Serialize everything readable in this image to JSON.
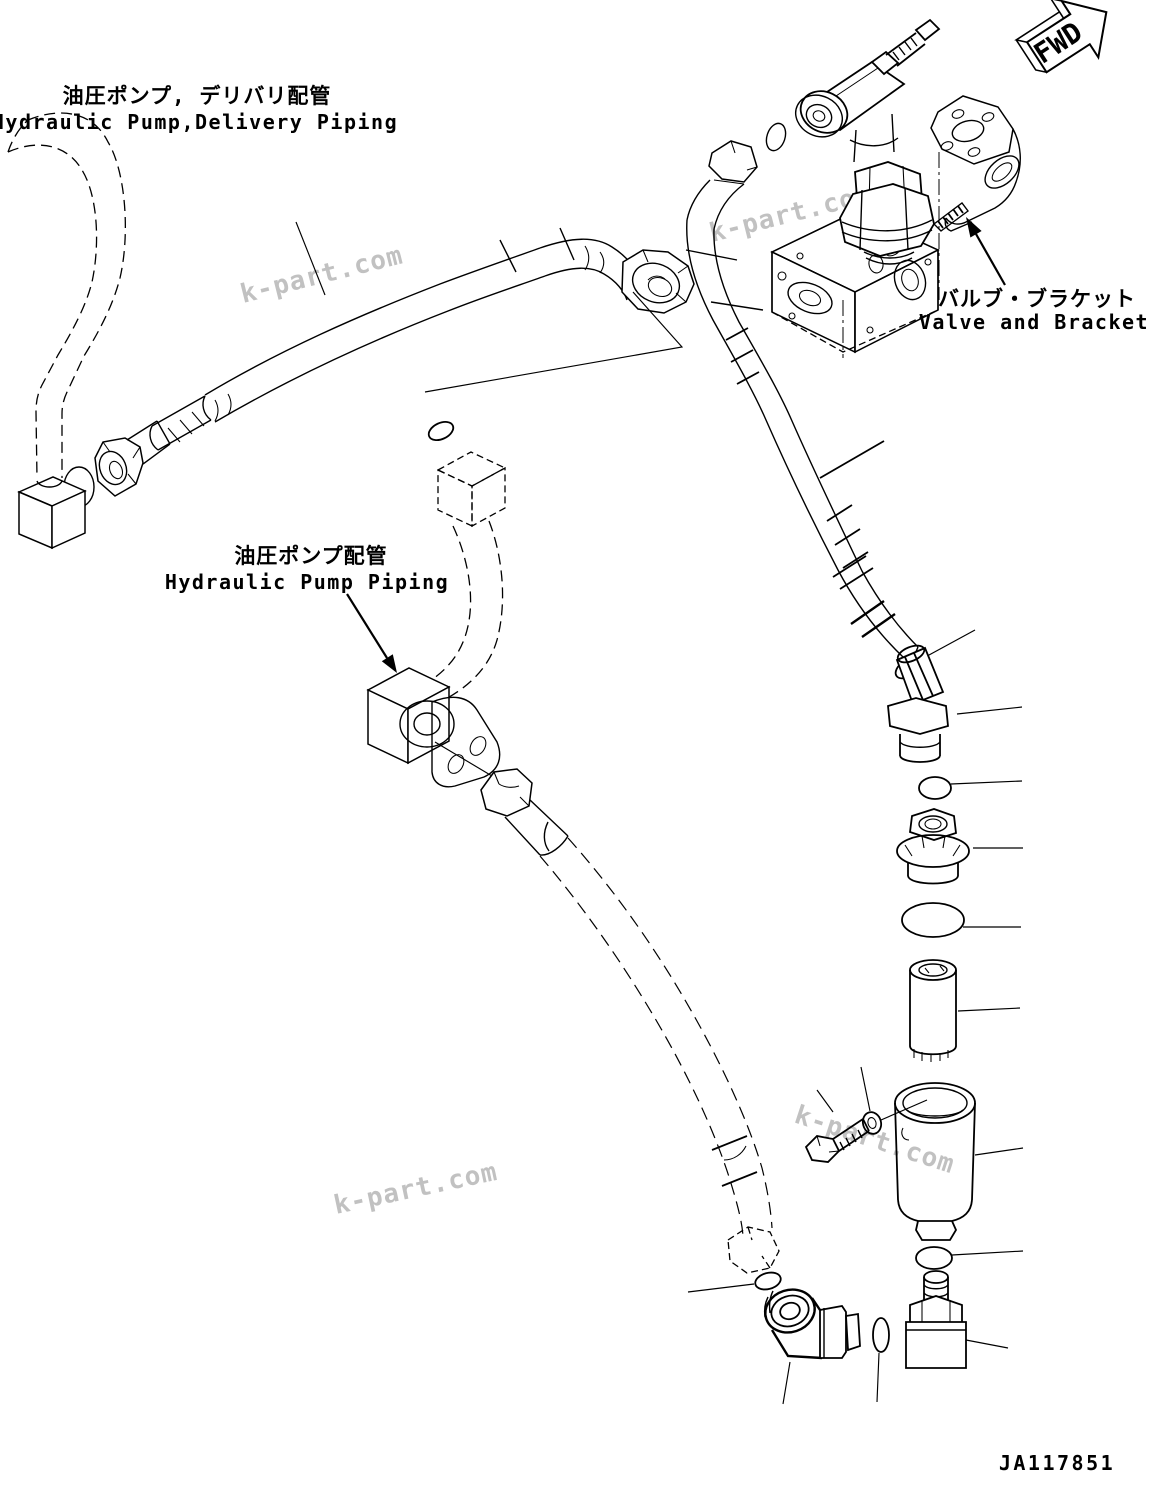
{
  "page": {
    "background": "#ffffff",
    "line_color": "#000000",
    "watermark_color": "#b2b2b2"
  },
  "labels": {
    "delivery_piping": {
      "jp": "油圧ポンプ, デリバリ配管",
      "en": "Hydraulic Pump,Delivery Piping"
    },
    "pump_piping": {
      "jp": "油圧ポンプ配管",
      "en": "Hydraulic Pump Piping"
    },
    "valve_bracket": {
      "jp": "バルブ・ブラケット",
      "en": "Valve and Bracket"
    }
  },
  "orientation_arrow": {
    "label": "FWD"
  },
  "drawing_number": "JA117851",
  "watermark": {
    "text": "k-part.com"
  }
}
